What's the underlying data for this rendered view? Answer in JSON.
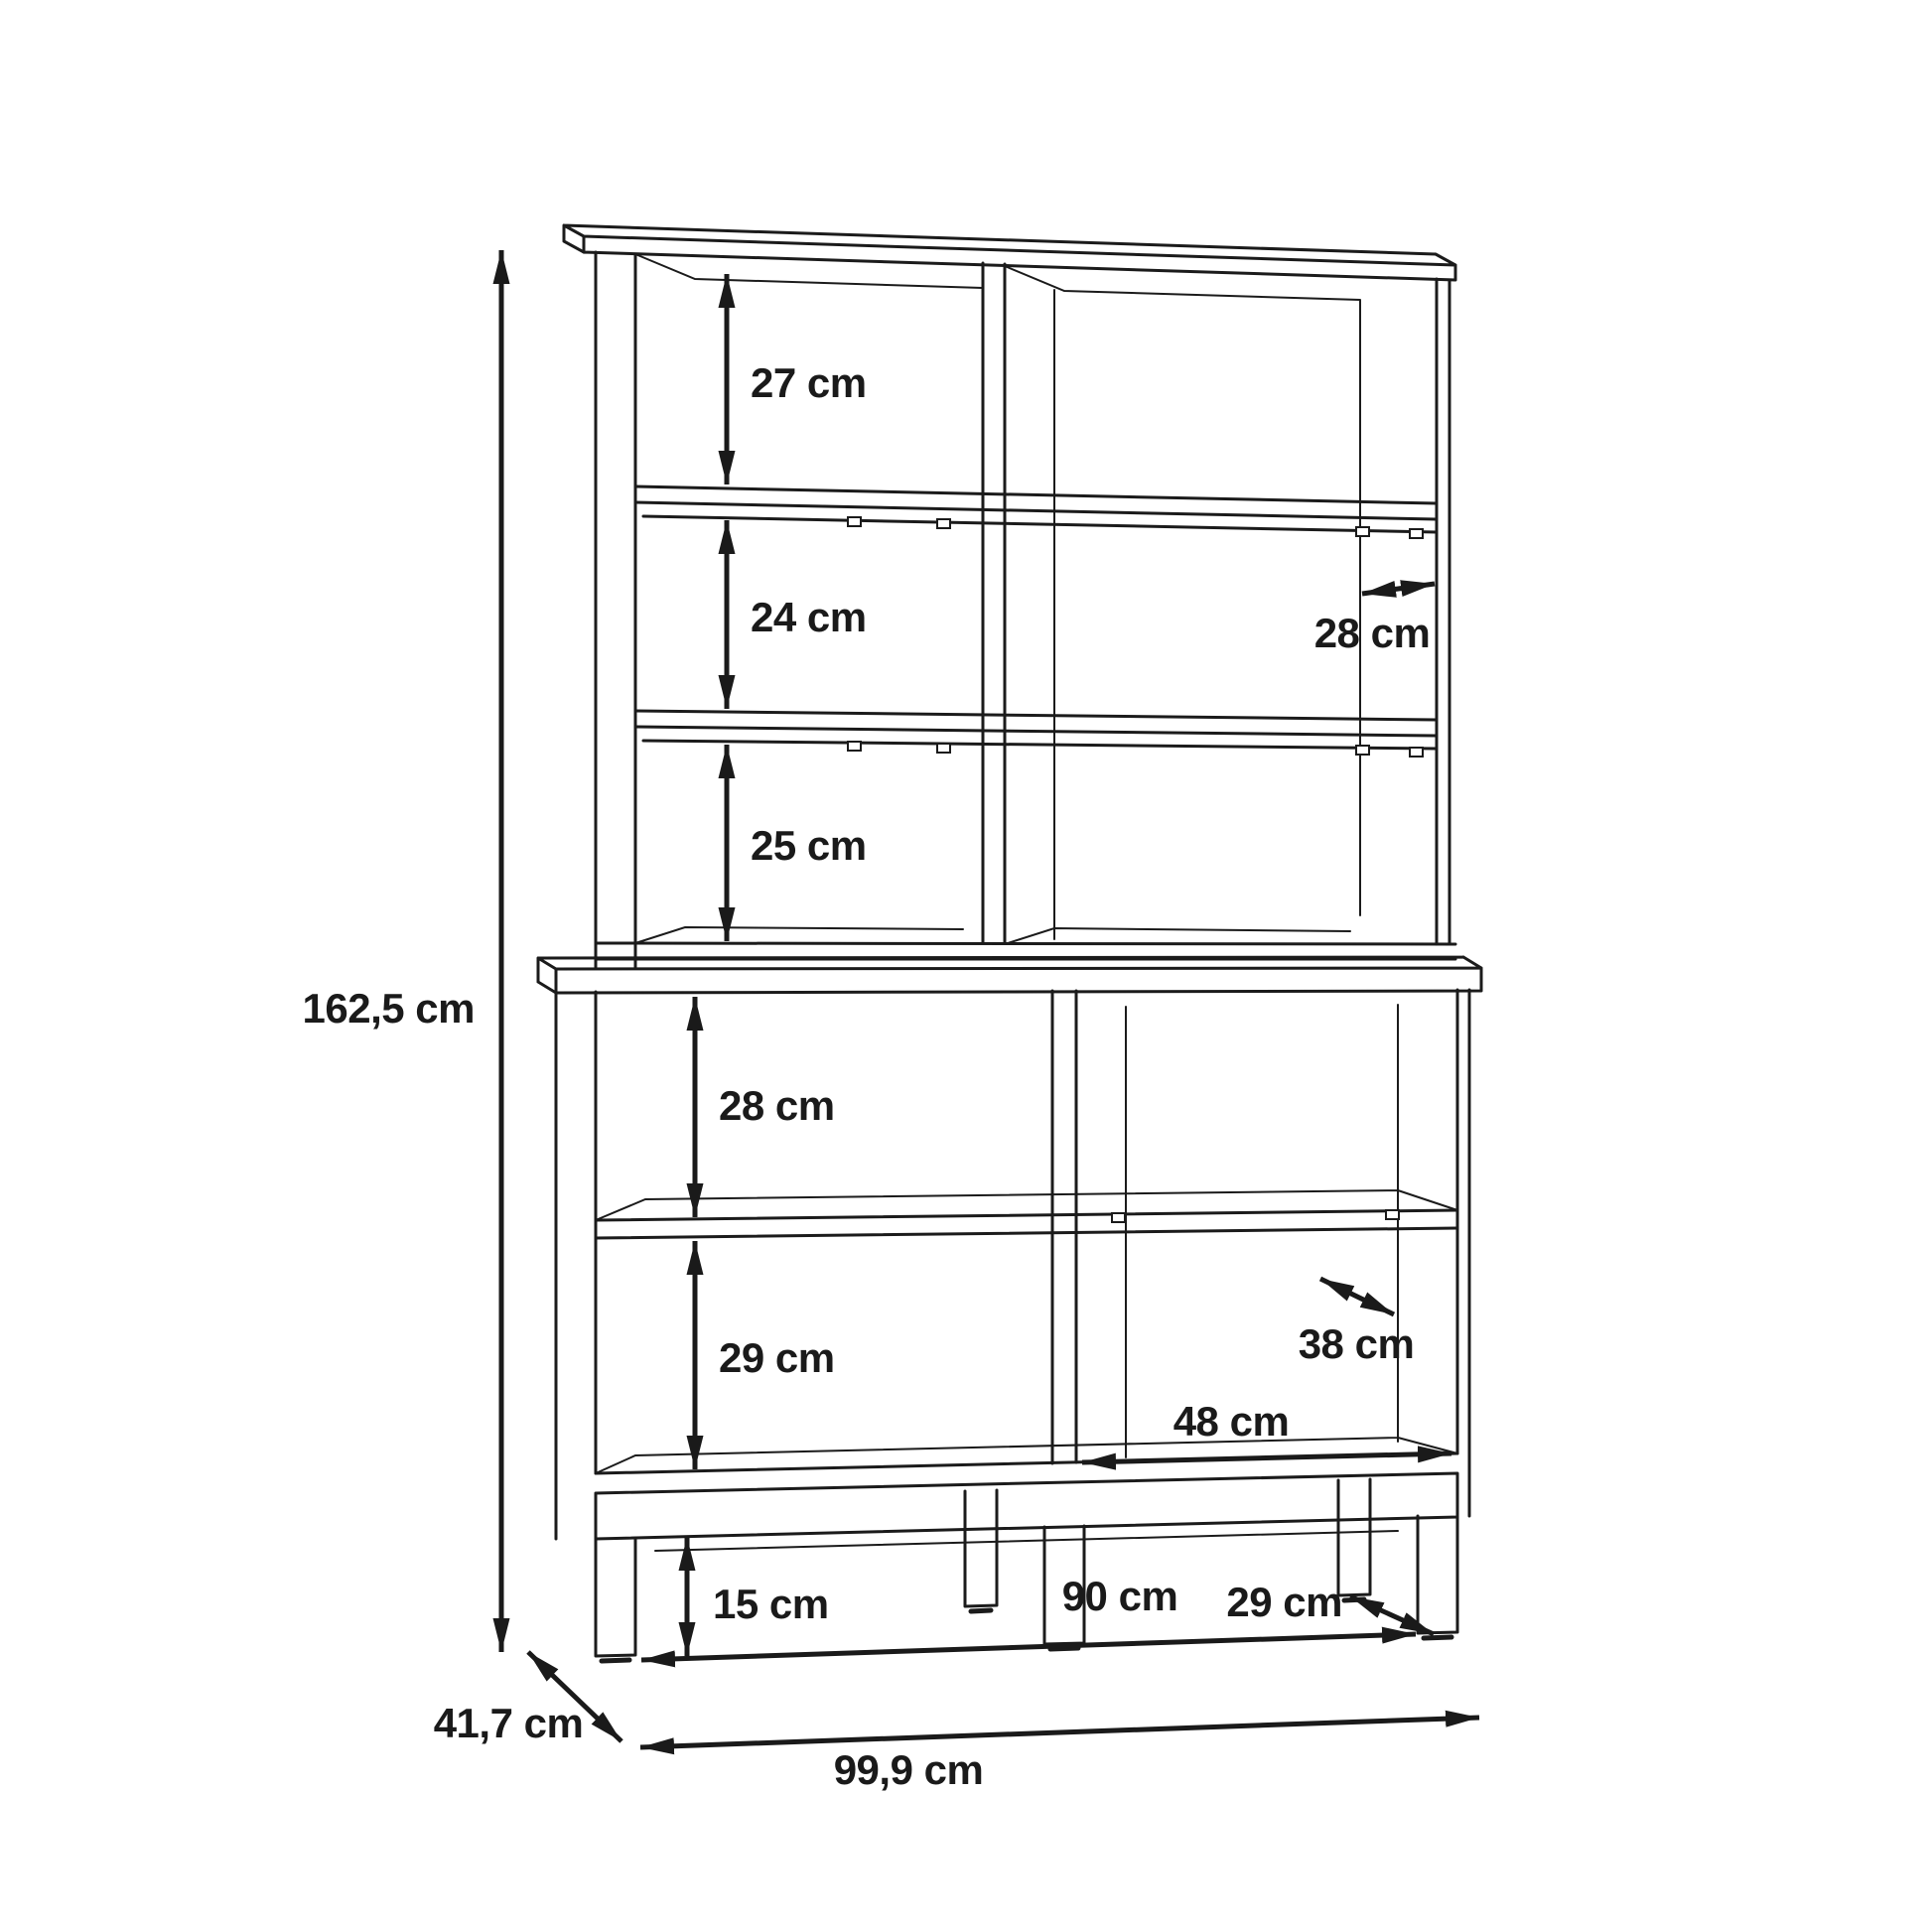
{
  "diagram": {
    "type": "furniture-dimension-drawing",
    "subject": "open shelving cabinet (two-part bookcase on legs), 3D line drawing with dimension arrows",
    "background_color": "#ffffff",
    "line_color": "#1b1b1b",
    "unit": "cm",
    "dimensions": {
      "overall_height": "162,5 cm",
      "upper_compartment_top_height": "27 cm",
      "upper_compartment_middle_height": "24 cm",
      "upper_compartment_bottom_height": "25 cm",
      "upper_shelf_depth": "28 cm",
      "lower_compartment_top_height": "28 cm",
      "lower_compartment_bottom_height": "29 cm",
      "lower_shelf_depth": "38 cm",
      "lower_right_compartment_width": "48 cm",
      "base_clearance_height": "15 cm",
      "base_inner_width": "90 cm",
      "base_leg_depth": "29 cm",
      "overall_depth": "41,7 cm",
      "overall_width": "99,9 cm"
    }
  }
}
